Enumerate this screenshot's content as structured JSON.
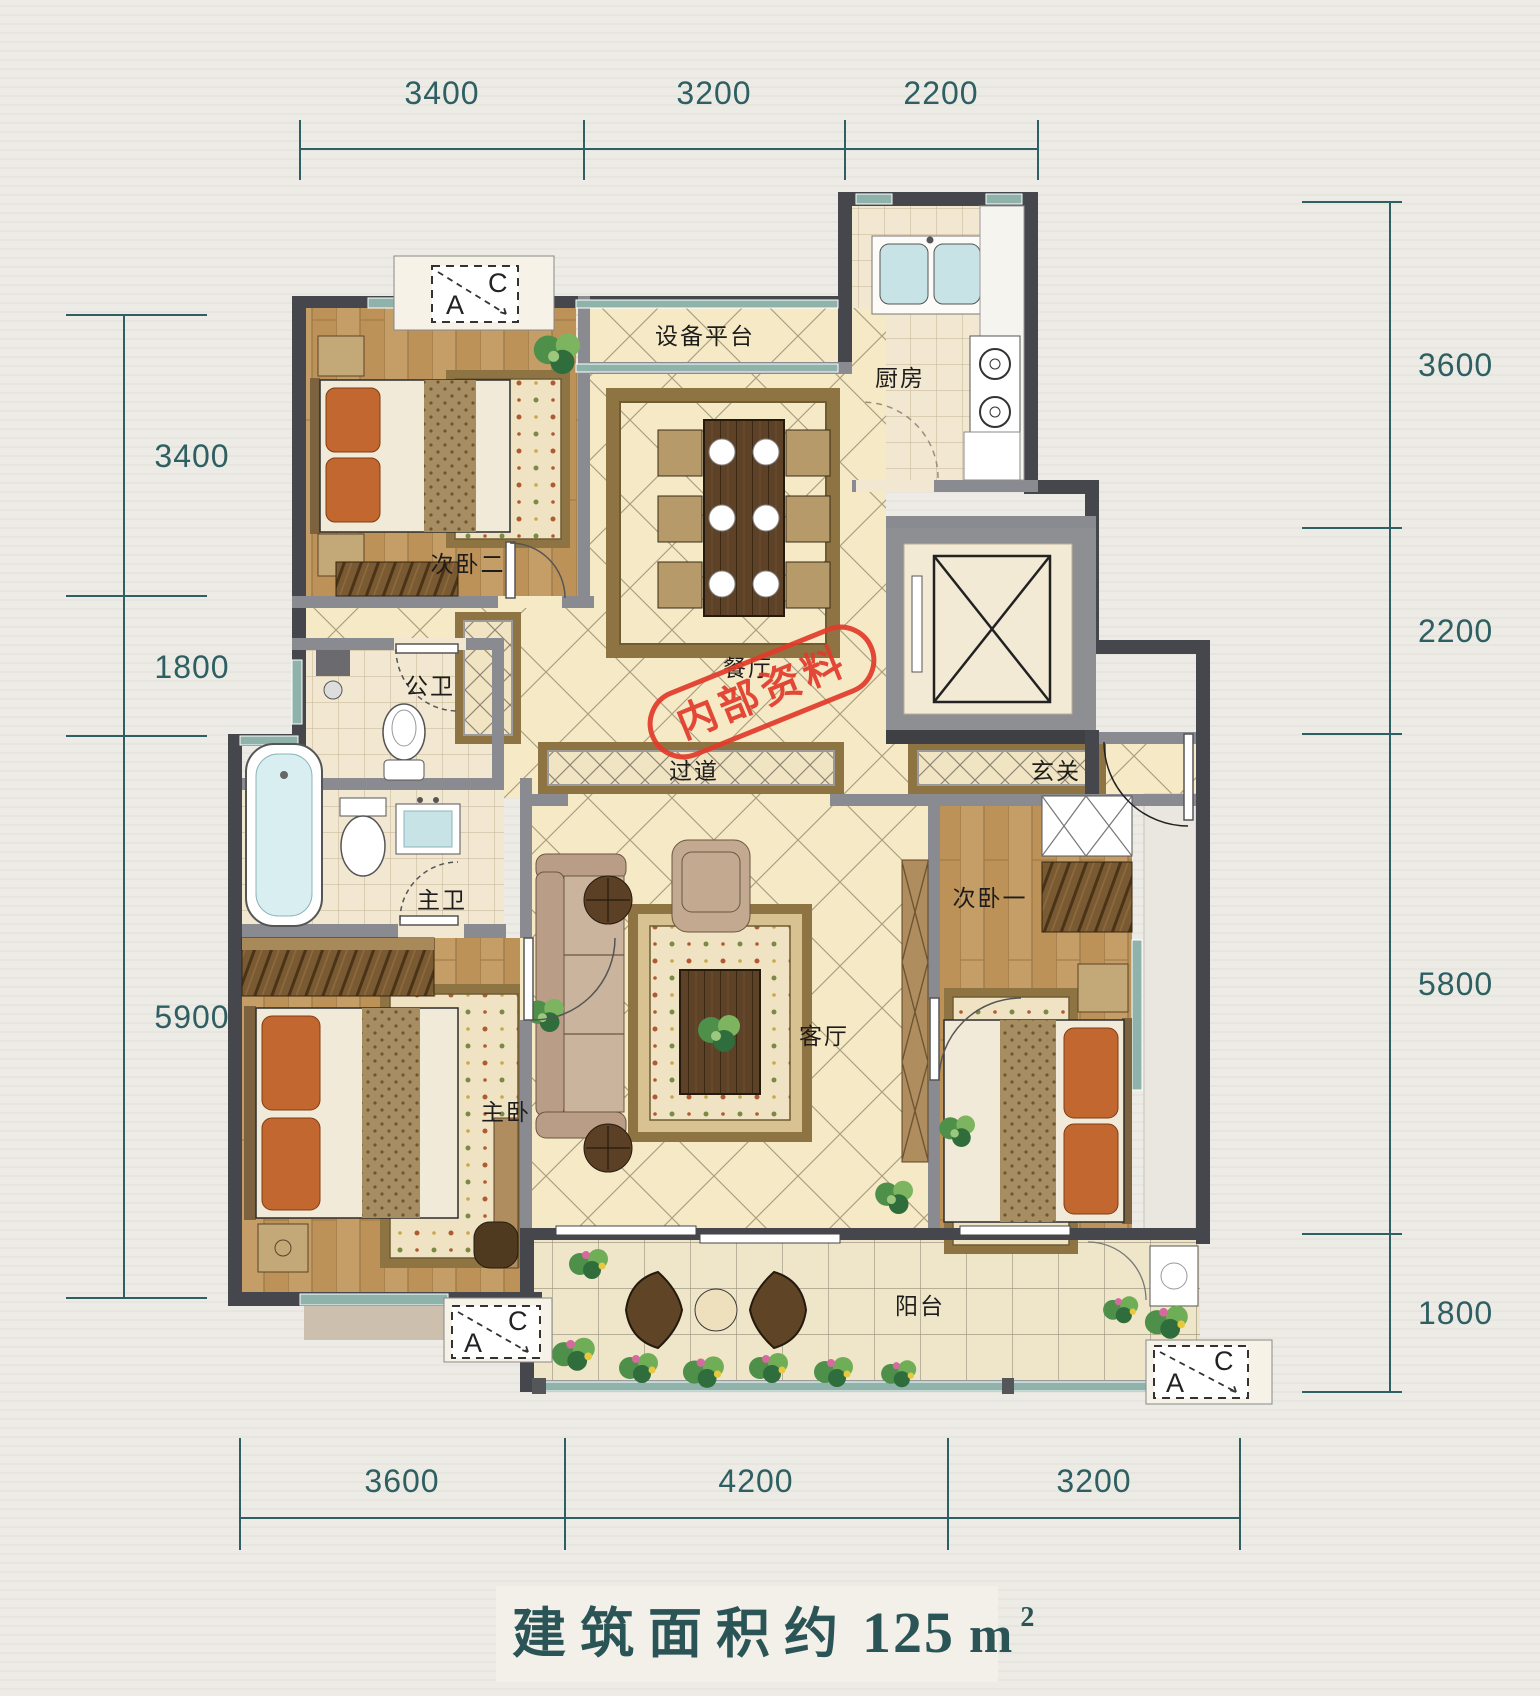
{
  "page": {
    "background": "#edebe5"
  },
  "title": {
    "prefix": "建筑面积约",
    "number": "125",
    "unit": "m",
    "sup": "2"
  },
  "dims": {
    "top": [
      "3400",
      "3200",
      "2200"
    ],
    "right": [
      "3600",
      "2200",
      "5800",
      "1800"
    ],
    "left": [
      "3400",
      "1800",
      "5900"
    ],
    "bottom": [
      "3600",
      "4200",
      "3200"
    ]
  },
  "rooms": {
    "bedroom2": "次卧二",
    "equipment_platform": "设备平台",
    "kitchen": "厨房",
    "public_bath": "公卫",
    "dining": "餐厅",
    "hallway": "过道",
    "foyer": "玄关",
    "master_bath": "主卫",
    "master_bedroom": "主卧",
    "living_room": "客厅",
    "bedroom1": "次卧一",
    "balcony": "阳台"
  },
  "stamp": {
    "text": "内部资料",
    "color": "#e23b2b"
  },
  "ac_marker": {
    "a": "A",
    "c": "C"
  },
  "colors": {
    "dimension": "#2d5f63",
    "wall_dark": "#46474c",
    "wall_gray": "#8a8b90",
    "window_teal": "#8fb3ab",
    "wood_floor": "#c49d67",
    "marble_floor": "#f5e9c6",
    "rug_border": "#8f7443",
    "accent_orange": "#c2672f",
    "stamp_red": "#e23b2b",
    "title_teal": "#2b5456"
  }
}
